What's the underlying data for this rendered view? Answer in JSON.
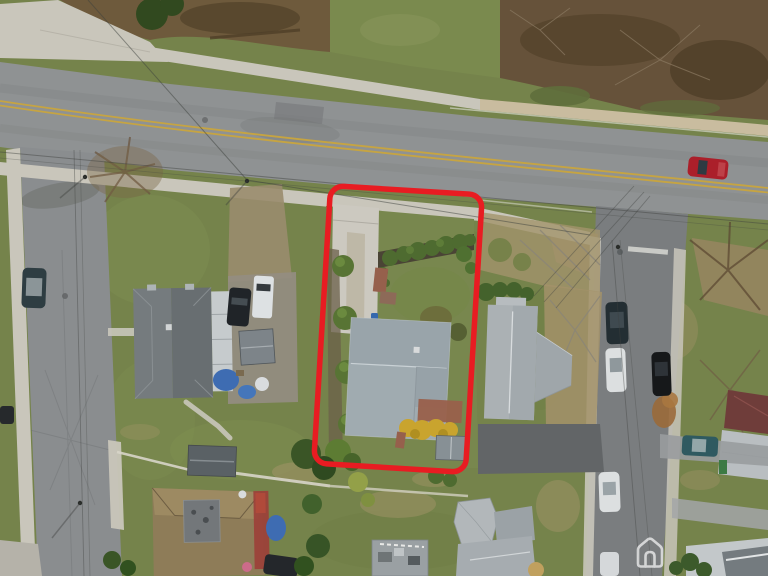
{
  "meta": {
    "type": "aerial-drone-photograph",
    "description": "Top-down aerial photo of a suburban residential block in early spring; a red rounded-rectangle outline highlights the subject property lot.",
    "width_px": 768,
    "height_px": 576
  },
  "annotation": {
    "label": "subject-property-outline",
    "x": 322,
    "y": 190,
    "width": 152,
    "height": 278,
    "rx": 13,
    "rotation_deg": 3.5,
    "stroke_width": 5.5
  },
  "watermark": {
    "icon": "house-logo-icon",
    "color": "#FFFFFF",
    "opacity": 0.68
  },
  "colors": {
    "grass_base": "#75834B",
    "grass_light": "#8C9C5C",
    "grass_dark": "#5D6E3A",
    "grass_dry": "#A29467",
    "road_asphalt": "#8F9293",
    "street_left": "#8A8D8F",
    "street_right": "#7A7D7F",
    "sidewalk": "#C9C6BB",
    "path_tan": "#C9BC9F",
    "woods_brown": "#6E5A3C",
    "woods_dark": "#54432B",
    "meadow_green": "#7A8A4E",
    "tree_dark": "#3A5526",
    "shrub_green": "#4E6B30",
    "hedge_soil": "#4A4435",
    "roof_subject": "#A0ABB0",
    "roof_left": "#6E7578",
    "roof_right": "#ABB1B4",
    "roof_brown": "#8E7C58",
    "roof_maroon": "#6F3D3A",
    "shed_dark": "#5A6165",
    "shed_gray": "#879095",
    "brick": "#96604C",
    "forsythia": "#C9A42E",
    "driveway_concrete": "#CCC9C0",
    "gravel": "#9A8C6E",
    "asphalt_dark": "#626567",
    "yellow_line": "#C9A53D",
    "white_line": "#E4E4DE",
    "red_outline": "#E81C22",
    "car_red": "#AB1F2A",
    "car_black": "#202428",
    "car_white": "#DCDFE0",
    "car_teal": "#2F5A60",
    "tarp_blue": "#3E6CB2",
    "bin_blue": "#3668AD",
    "bin_green": "#3C7A44",
    "wire": "#3E413E"
  },
  "scene": {
    "roads": [
      "main road with double yellow center line running diagonally across upper area",
      "left side street running vertically",
      "right side street running vertically from intersection"
    ],
    "highlighted_property_contents": [
      "gray gable-roof house",
      "ribbon concrete driveway",
      "hedge row with shrubs",
      "four round foundation bushes",
      "brick steps and walkway",
      "rear brick patio",
      "yellow forsythia bushes",
      "small gray shed",
      "blue bin"
    ],
    "vehicles": [
      {
        "color": "red",
        "location": "driving on main road, upper right"
      },
      {
        "color": "dark teal",
        "location": "parked on left street"
      },
      {
        "color": "dark",
        "location": "left image edge, lower left street"
      },
      {
        "color": "black",
        "location": "left neighbor driveway"
      },
      {
        "color": "white van",
        "location": "left neighbor driveway"
      },
      {
        "color": "dark",
        "location": "right street, west side"
      },
      {
        "color": "white",
        "location": "right street, west side"
      },
      {
        "color": "black",
        "location": "right street, east side"
      },
      {
        "color": "white",
        "location": "right street, lower"
      },
      {
        "color": "white",
        "location": "right street, bottom edge"
      },
      {
        "color": "teal",
        "location": "driveway at far right"
      },
      {
        "color": "dark",
        "location": "bottom house driveway"
      }
    ],
    "buildings": [
      "subject house (center, outlined)",
      "left neighbor house with white sunroom roof",
      "right neighbor house with T-shaped gray roof",
      "maroon/gray roof house at far right",
      "brown-roof house bottom left with gray deck",
      "dark shed",
      "flat-roof structure bottom center",
      "gray house bottom center-right",
      "rooftops at bottom right corner"
    ]
  }
}
